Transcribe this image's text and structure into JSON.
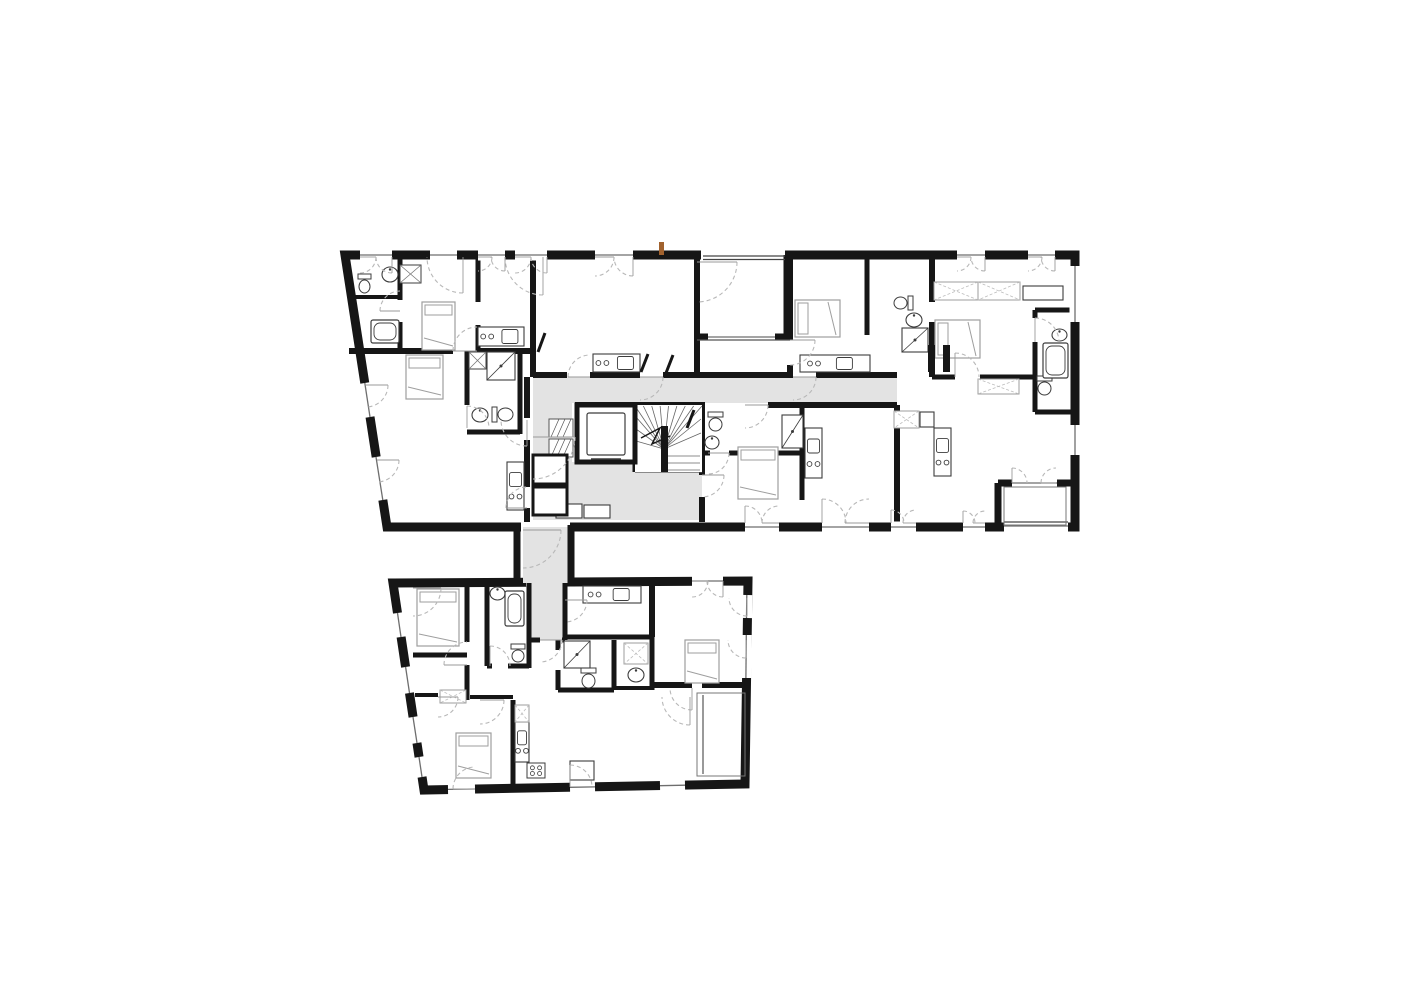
{
  "canvas": {
    "w": 1415,
    "h": 1000
  },
  "colors": {
    "background": "#ffffff",
    "wall": "#161616",
    "corridor": "#e3e3e3",
    "fixture": "#3c3c3c",
    "furniture": "#9e9e9e",
    "wardrobe_x": "#bdbdbd",
    "door_arc": "#b8b8b8",
    "thin": "#555555",
    "window_line": "#6e6e6e",
    "accent": "#a1622e"
  },
  "outlines": [
    {
      "name": "upper-building",
      "thickness": 9,
      "points": [
        [
          345,
          255
        ],
        [
          1075,
          255
        ],
        [
          1075,
          527
        ],
        [
          387,
          527
        ]
      ]
    },
    {
      "name": "lower-building",
      "thickness": 9,
      "points": [
        [
          393,
          583
        ],
        [
          748,
          581
        ],
        [
          745,
          784
        ],
        [
          424,
          790
        ]
      ]
    }
  ],
  "covers": [
    [
      701,
      250.5,
      84,
      9
    ],
    [
      521,
      522.5,
      49,
      9
    ],
    [
      526,
      577.5,
      41,
      9
    ]
  ],
  "corridors": [
    [
      [
        533,
        377
      ],
      [
        897,
        377
      ],
      [
        897,
        403
      ],
      [
        533,
        403
      ]
    ],
    [
      [
        533,
        403
      ],
      [
        572,
        403
      ],
      [
        572,
        520
      ],
      [
        533,
        520
      ]
    ],
    [
      [
        572,
        462
      ],
      [
        635,
        462
      ],
      [
        635,
        472
      ],
      [
        702,
        472
      ],
      [
        702,
        520
      ],
      [
        572,
        520
      ]
    ],
    [
      [
        523,
        527
      ],
      [
        568,
        527
      ],
      [
        568,
        583
      ],
      [
        523,
        583
      ]
    ],
    [
      [
        528,
        583
      ],
      [
        565,
        583
      ],
      [
        565,
        640
      ],
      [
        528,
        640
      ]
    ]
  ],
  "connector_walls": [
    [
      517,
      525,
      517,
      585,
      7
    ],
    [
      571,
      525,
      571,
      585,
      7
    ]
  ],
  "walls": [
    [
      349,
      351,
      453,
      351,
      6
    ],
    [
      477,
      351,
      533,
      351,
      6
    ],
    [
      400,
      259,
      400,
      300,
      5
    ],
    [
      400,
      322,
      400,
      351,
      5
    ],
    [
      349,
      297,
      400,
      297,
      4
    ],
    [
      478,
      255,
      478,
      302,
      5
    ],
    [
      478,
      325,
      478,
      351,
      5
    ],
    [
      533,
      255,
      533,
      377,
      6
    ],
    [
      467,
      351,
      467,
      405,
      5
    ],
    [
      520,
      351,
      520,
      434,
      5
    ],
    [
      467,
      432,
      520,
      432,
      5
    ],
    [
      527,
      377,
      527,
      418,
      6
    ],
    [
      527,
      440,
      527,
      487,
      6
    ],
    [
      527,
      508,
      527,
      522,
      6
    ],
    [
      533,
      375,
      567,
      375,
      6
    ],
    [
      590,
      375,
      640,
      375,
      6
    ],
    [
      663,
      375,
      697,
      375,
      6
    ],
    [
      697,
      255,
      697,
      375,
      6
    ],
    [
      697,
      375,
      793,
      375,
      6
    ],
    [
      816,
      375,
      897,
      375,
      6
    ],
    [
      787,
      255,
      787,
      340,
      7
    ],
    [
      700,
      337,
      708,
      337,
      7
    ],
    [
      775,
      337,
      787,
      337,
      7
    ],
    [
      790,
      255,
      790,
      340,
      6
    ],
    [
      790,
      365,
      790,
      377,
      6
    ],
    [
      867,
      255,
      867,
      335,
      5
    ],
    [
      867,
      358,
      867,
      377,
      5
    ],
    [
      932,
      255,
      932,
      302,
      6
    ],
    [
      932,
      322,
      932,
      377,
      6
    ],
    [
      932,
      377,
      955,
      377,
      5
    ],
    [
      980,
      377,
      1035,
      377,
      5
    ],
    [
      1035,
      310,
      1075,
      310,
      5
    ],
    [
      1035,
      310,
      1035,
      318,
      5
    ],
    [
      1035,
      342,
      1035,
      412,
      5
    ],
    [
      1035,
      412,
      1075,
      412,
      5
    ],
    [
      897,
      405,
      897,
      522,
      6
    ],
    [
      575,
      405,
      705,
      405,
      6
    ],
    [
      768,
      405,
      897,
      405,
      6
    ],
    [
      702,
      405,
      702,
      475,
      6
    ],
    [
      702,
      497,
      702,
      522,
      6
    ],
    [
      705,
      453,
      710,
      453,
      5
    ],
    [
      729,
      453,
      802,
      453,
      5
    ],
    [
      802,
      405,
      802,
      500,
      5
    ],
    [
      998,
      483,
      1012,
      483,
      7
    ],
    [
      1057,
      483,
      1075,
      483,
      7
    ],
    [
      998,
      483,
      998,
      527,
      7
    ],
    [
      635,
      405,
      635,
      472,
      5
    ],
    [
      467,
      583,
      467,
      642,
      5
    ],
    [
      467,
      665,
      467,
      700,
      5
    ],
    [
      487,
      583,
      487,
      666,
      5
    ],
    [
      487,
      666,
      492,
      666,
      5
    ],
    [
      508,
      666,
      529,
      666,
      5
    ],
    [
      529,
      583,
      529,
      668,
      5
    ],
    [
      565,
      583,
      565,
      640,
      5
    ],
    [
      529,
      640,
      540,
      640,
      5
    ],
    [
      562,
      640,
      565,
      640,
      5
    ],
    [
      565,
      637,
      652,
      637,
      5
    ],
    [
      558,
      640,
      558,
      650,
      5
    ],
    [
      558,
      670,
      558,
      690,
      5
    ],
    [
      614,
      640,
      614,
      690,
      5
    ],
    [
      558,
      690,
      614,
      690,
      5
    ],
    [
      652,
      637,
      652,
      690,
      5
    ],
    [
      614,
      688,
      652,
      688,
      4
    ],
    [
      413,
      655,
      467,
      655,
      5
    ],
    [
      415,
      695,
      438,
      695,
      4
    ],
    [
      470,
      697,
      513,
      697,
      4
    ],
    [
      513,
      700,
      513,
      786,
      5
    ],
    [
      652,
      685,
      692,
      685,
      6
    ],
    [
      702,
      685,
      748,
      685,
      6
    ],
    [
      652,
      583,
      652,
      637,
      6
    ]
  ],
  "windows": [
    [
      360,
      255,
      392,
      255
    ],
    [
      430,
      255,
      457,
      255
    ],
    [
      478,
      255,
      505,
      255
    ],
    [
      515,
      255,
      547,
      255
    ],
    [
      595,
      255,
      633,
      255
    ],
    [
      957,
      255,
      985,
      255
    ],
    [
      1028,
      255,
      1055,
      255
    ],
    [
      364.8,
      383,
      370,
      417
    ],
    [
      376,
      457,
      382.8,
      500
    ],
    [
      745,
      527,
      779,
      527
    ],
    [
      822,
      527,
      869,
      527
    ],
    [
      891,
      527,
      916,
      527
    ],
    [
      963,
      527,
      985,
      527
    ],
    [
      1004,
      526,
      1068,
      526
    ],
    [
      1075,
      266,
      1075,
      322
    ],
    [
      1075,
      425,
      1075,
      455
    ],
    [
      708,
      337,
      775,
      337
    ],
    [
      1012,
      483,
      1057,
      483
    ],
    [
      397.5,
      613,
      401,
      637
    ],
    [
      405.6,
      667,
      409.5,
      693
    ],
    [
      413,
      717,
      417,
      743
    ],
    [
      419,
      757,
      422,
      777
    ],
    [
      448,
      789.4,
      475,
      789
    ],
    [
      570,
      787.3,
      595,
      786.9
    ],
    [
      660,
      785.7,
      685,
      785.2
    ],
    [
      746.8,
      595,
      746.5,
      618
    ],
    [
      746.3,
      635,
      745.9,
      678
    ],
    [
      692,
      581,
      723,
      581
    ]
  ],
  "railings": [
    [
      703,
      256,
      785,
      256
    ],
    [
      703,
      259.5,
      785,
      259.5
    ],
    [
      1004,
      522,
      1068,
      522
    ]
  ],
  "thin_lines": [
    [
      635,
      472,
      702,
      472
    ],
    [
      697,
      340,
      790,
      340
    ],
    [
      703,
      695,
      703,
      774
    ]
  ],
  "stair": {
    "x": 635,
    "y": 405,
    "w": 67,
    "h": 67,
    "pivot": [
      664,
      449
    ]
  },
  "elevator": {
    "x": 577,
    "y": 405,
    "w": 58,
    "h": 57,
    "car": [
      587,
      413,
      38,
      42
    ]
  },
  "furniture": [
    {
      "t": "bed",
      "x": 422,
      "y": 302,
      "w": 33,
      "h": 48,
      "p": "t"
    },
    {
      "t": "bed",
      "x": 406,
      "y": 355,
      "w": 37,
      "h": 44,
      "p": "t"
    },
    {
      "t": "bed",
      "x": 795,
      "y": 300,
      "w": 45,
      "h": 37,
      "p": "l"
    },
    {
      "t": "bed",
      "x": 935,
      "y": 320,
      "w": 45,
      "h": 38,
      "p": "l"
    },
    {
      "t": "bed",
      "x": 738,
      "y": 447,
      "w": 40,
      "h": 52,
      "p": "t"
    },
    {
      "t": "bed",
      "x": 417,
      "y": 589,
      "w": 42,
      "h": 57,
      "p": "t"
    },
    {
      "t": "bed",
      "x": 685,
      "y": 640,
      "w": 34,
      "h": 43,
      "p": "t"
    },
    {
      "t": "bed",
      "x": 456,
      "y": 733,
      "w": 35,
      "h": 45,
      "p": "t"
    },
    {
      "t": "kitchen",
      "x": 478,
      "y": 327,
      "w": 46,
      "h": 19,
      "o": "h"
    },
    {
      "t": "kitchen",
      "x": 593,
      "y": 354,
      "w": 47,
      "h": 18,
      "o": "h"
    },
    {
      "t": "kitchen",
      "x": 800,
      "y": 355,
      "w": 70,
      "h": 17,
      "o": "h"
    },
    {
      "t": "kitchen",
      "x": 934,
      "y": 428,
      "w": 17,
      "h": 48,
      "o": "v"
    },
    {
      "t": "kitchen",
      "x": 805,
      "y": 428,
      "w": 17,
      "h": 50,
      "o": "v"
    },
    {
      "t": "kitchen",
      "x": 507,
      "y": 462,
      "w": 17,
      "h": 48,
      "o": "v"
    },
    {
      "t": "kitchen",
      "x": 583,
      "y": 586,
      "w": 58,
      "h": 17,
      "o": "h"
    },
    {
      "t": "kitchen",
      "x": 515,
      "y": 722,
      "w": 14,
      "h": 40,
      "o": "v"
    },
    {
      "t": "toilet",
      "x": 358,
      "y": 274,
      "w": 13,
      "h": 20,
      "d": "d"
    },
    {
      "t": "toilet",
      "x": 492,
      "y": 407,
      "w": 22,
      "h": 15,
      "d": "r"
    },
    {
      "t": "toilet",
      "x": 893,
      "y": 296,
      "w": 20,
      "h": 14,
      "d": "l"
    },
    {
      "t": "toilet",
      "x": 708,
      "y": 412,
      "w": 15,
      "h": 20,
      "d": "d"
    },
    {
      "t": "toilet",
      "x": 1037,
      "y": 376,
      "w": 15,
      "h": 20,
      "d": "d"
    },
    {
      "t": "toilet",
      "x": 511,
      "y": 644,
      "w": 14,
      "h": 19,
      "d": "d"
    },
    {
      "t": "toilet",
      "x": 581,
      "y": 668,
      "w": 15,
      "h": 21,
      "d": "d"
    },
    {
      "t": "sink",
      "x": 382,
      "y": 267,
      "w": 16,
      "h": 15
    },
    {
      "t": "sink",
      "x": 472,
      "y": 408,
      "w": 16,
      "h": 14
    },
    {
      "t": "sink",
      "x": 906,
      "y": 313,
      "w": 16,
      "h": 14
    },
    {
      "t": "sink",
      "x": 705,
      "y": 436,
      "w": 14,
      "h": 13
    },
    {
      "t": "sink",
      "x": 1052,
      "y": 329,
      "w": 15,
      "h": 12
    },
    {
      "t": "sink",
      "x": 490,
      "y": 587,
      "w": 15,
      "h": 13
    },
    {
      "t": "sink",
      "x": 628,
      "y": 668,
      "w": 16,
      "h": 14
    },
    {
      "t": "tub",
      "x": 371,
      "y": 320,
      "w": 28,
      "h": 23
    },
    {
      "t": "tub",
      "x": 1043,
      "y": 343,
      "w": 25,
      "h": 35
    },
    {
      "t": "tub",
      "x": 505,
      "y": 591,
      "w": 19,
      "h": 35
    },
    {
      "t": "shower",
      "x": 487,
      "y": 352,
      "w": 28,
      "h": 28
    },
    {
      "t": "shower",
      "x": 902,
      "y": 328,
      "w": 26,
      "h": 24
    },
    {
      "t": "shower",
      "x": 782,
      "y": 415,
      "w": 21,
      "h": 33
    },
    {
      "t": "shower",
      "x": 564,
      "y": 641,
      "w": 26,
      "h": 27
    },
    {
      "t": "tray",
      "x": 400,
      "y": 265,
      "w": 21,
      "h": 18
    },
    {
      "t": "tray",
      "x": 469,
      "y": 352,
      "w": 17,
      "h": 17
    },
    {
      "t": "wardrobe",
      "x": 934,
      "y": 282,
      "w": 44,
      "h": 18
    },
    {
      "t": "wardrobe",
      "x": 978,
      "y": 282,
      "w": 42,
      "h": 18
    },
    {
      "t": "wardrobe",
      "x": 978,
      "y": 379,
      "w": 41,
      "h": 15
    },
    {
      "t": "wardrobe",
      "x": 894,
      "y": 411,
      "w": 25,
      "h": 17
    },
    {
      "t": "wardrobe",
      "x": 624,
      "y": 643,
      "w": 24,
      "h": 21
    },
    {
      "t": "wardrobe",
      "x": 440,
      "y": 690,
      "w": 26,
      "h": 13
    },
    {
      "t": "wardrobe",
      "x": 515,
      "y": 705,
      "w": 14,
      "h": 17
    },
    {
      "t": "box",
      "x": 1023,
      "y": 286,
      "w": 40,
      "h": 14
    },
    {
      "t": "box",
      "x": 920,
      "y": 412,
      "w": 14,
      "h": 15
    },
    {
      "t": "box",
      "x": 556,
      "y": 504,
      "w": 26,
      "h": 14
    },
    {
      "t": "box",
      "x": 584,
      "y": 505,
      "w": 26,
      "h": 13
    },
    {
      "t": "box",
      "x": 570,
      "y": 761,
      "w": 24,
      "h": 19
    },
    {
      "t": "stove4",
      "x": 527,
      "y": 763,
      "w": 18,
      "h": 15
    },
    {
      "t": "hatch",
      "x": 549,
      "y": 419,
      "w": 24,
      "h": 18
    },
    {
      "t": "hatch",
      "x": 549,
      "y": 439,
      "w": 24,
      "h": 18
    },
    {
      "t": "room",
      "x": 533,
      "y": 455,
      "w": 34,
      "h": 29
    },
    {
      "t": "room",
      "x": 533,
      "y": 487,
      "w": 34,
      "h": 28
    },
    {
      "t": "thinrect",
      "x": 1004,
      "y": 487,
      "w": 62,
      "h": 38
    },
    {
      "t": "thinrect",
      "x": 697,
      "y": 693,
      "w": 48,
      "h": 83
    },
    {
      "t": "blackrect",
      "x": 928,
      "y": 345,
      "w": 7,
      "h": 27
    },
    {
      "t": "blackrect",
      "x": 943,
      "y": 345,
      "w": 7,
      "h": 27
    }
  ],
  "leafs": [
    [
      545,
      333,
      538,
      352
    ],
    [
      648,
      354,
      641,
      372
    ],
    [
      673,
      355,
      666,
      373
    ],
    [
      694,
      410,
      687,
      428
    ]
  ],
  "door_arcs": [
    [
      400,
      311,
      20,
      180,
      270
    ],
    [
      463,
      257,
      36,
      90,
      180
    ],
    [
      543,
      257,
      38,
      90,
      180
    ],
    [
      697,
      262,
      40,
      0,
      90
    ],
    [
      590,
      377,
      22,
      180,
      270
    ],
    [
      640,
      377,
      23,
      0,
      90
    ],
    [
      793,
      377,
      23,
      0,
      90
    ],
    [
      745,
      405,
      23,
      0,
      90
    ],
    [
      708,
      453,
      21,
      0,
      90
    ],
    [
      955,
      377,
      24,
      270,
      360
    ],
    [
      1035,
      342,
      24,
      270,
      360
    ],
    [
      790,
      340,
      25,
      0,
      90
    ],
    [
      527,
      420,
      26,
      90,
      180
    ],
    [
      533,
      437,
      42,
      0,
      90
    ],
    [
      527,
      508,
      21,
      180,
      270
    ],
    [
      467,
      428,
      22,
      270,
      360
    ],
    [
      477,
      351,
      24,
      180,
      270
    ],
    [
      1012,
      483,
      15,
      270,
      360
    ],
    [
      1056,
      483,
      15,
      180,
      270
    ],
    [
      702,
      475,
      22,
      0,
      90
    ],
    [
      822,
      523,
      24,
      270,
      360
    ],
    [
      869,
      523,
      24,
      180,
      270
    ],
    [
      891,
      523,
      13,
      270,
      360
    ],
    [
      916,
      523,
      13,
      180,
      270
    ],
    [
      745,
      523,
      17,
      270,
      360
    ],
    [
      779,
      523,
      17,
      180,
      270
    ],
    [
      963,
      523,
      12,
      270,
      360
    ],
    [
      985,
      523,
      12,
      180,
      270
    ],
    [
      360,
      257,
      16,
      0,
      90
    ],
    [
      392,
      257,
      16,
      90,
      180
    ],
    [
      478,
      257,
      14,
      0,
      90
    ],
    [
      505,
      257,
      14,
      90,
      180
    ],
    [
      515,
      257,
      16,
      0,
      90
    ],
    [
      547,
      257,
      16,
      90,
      180
    ],
    [
      595,
      257,
      19,
      0,
      90
    ],
    [
      633,
      257,
      19,
      90,
      180
    ],
    [
      957,
      257,
      14,
      0,
      90
    ],
    [
      985,
      257,
      14,
      90,
      180
    ],
    [
      1028,
      257,
      14,
      0,
      90
    ],
    [
      1055,
      257,
      14,
      90,
      180
    ],
    [
      523,
      530,
      38,
      0,
      90
    ],
    [
      540,
      640,
      22,
      0,
      90
    ],
    [
      467,
      665,
      23,
      180,
      270
    ],
    [
      692,
      688,
      22,
      90,
      180
    ],
    [
      480,
      700,
      24,
      0,
      90
    ],
    [
      438,
      697,
      20,
      0,
      90
    ],
    [
      690,
      697,
      28,
      90,
      180
    ],
    [
      475,
      789,
      22,
      180,
      270
    ],
    [
      570,
      787,
      22,
      270,
      360
    ],
    [
      747,
      598,
      18,
      90,
      180
    ],
    [
      746,
      640,
      18,
      90,
      180
    ],
    [
      413,
      588,
      28,
      0,
      90
    ],
    [
      692,
      581,
      16,
      0,
      90
    ],
    [
      723,
      581,
      16,
      90,
      180
    ],
    [
      565,
      600,
      22,
      0,
      90
    ],
    [
      490,
      666,
      20,
      270,
      360
    ],
    [
      366,
      385,
      22,
      0,
      90
    ],
    [
      377,
      460,
      22,
      0,
      90
    ]
  ],
  "accent_mark": {
    "x": 659,
    "y": 242,
    "w": 5,
    "h": 13
  }
}
